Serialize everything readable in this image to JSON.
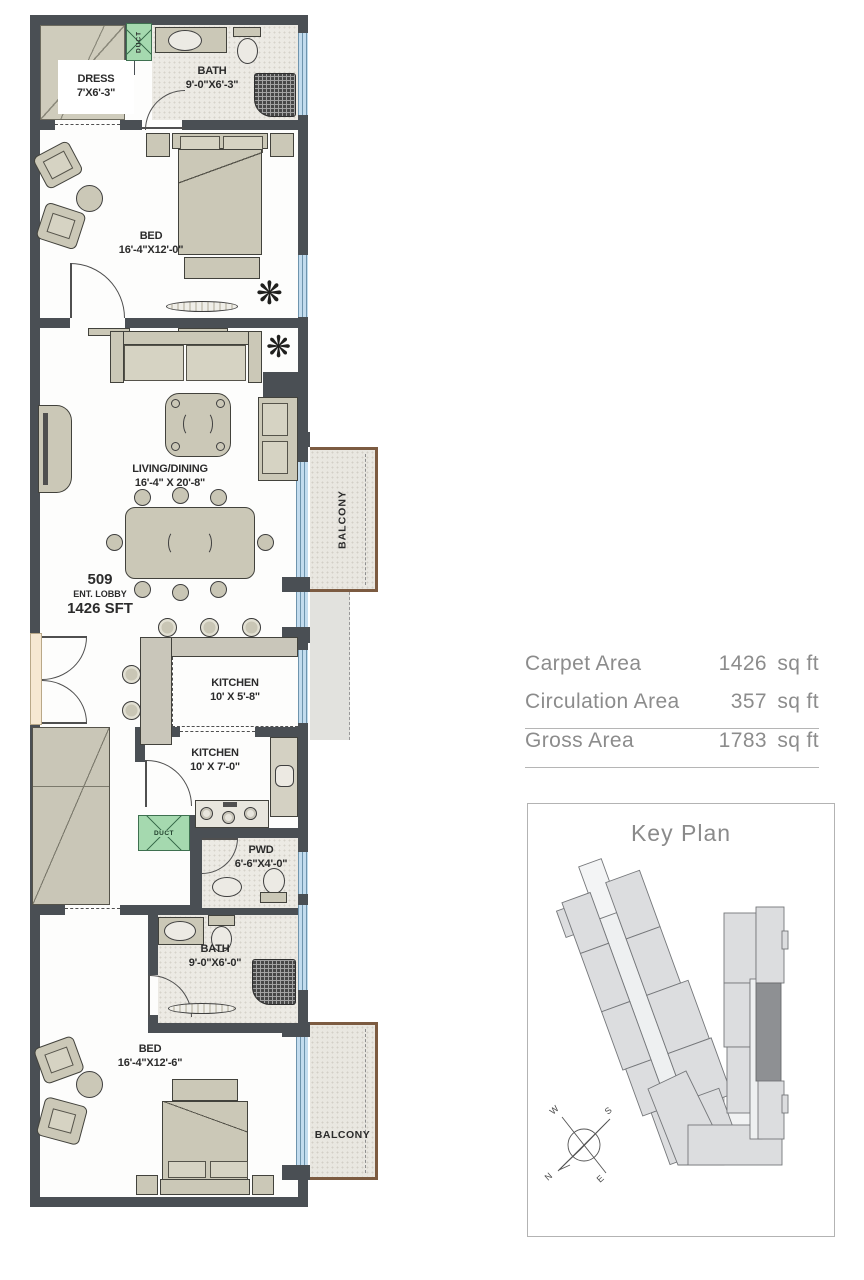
{
  "plan": {
    "unit": {
      "number": "509",
      "label": "ENT. LOBBY",
      "area": "1426 SFT"
    },
    "rooms": {
      "dress": {
        "name": "DRESS",
        "dim": "7'X6'-3\""
      },
      "bath_top": {
        "name": "BATH",
        "dim": "9'-0\"X6'-3\""
      },
      "bed_top": {
        "name": "BED",
        "dim": "16'-4\"X12'-0\""
      },
      "living": {
        "name": "LIVING/DINING",
        "dim": "16'-4\" X 20'-8\""
      },
      "kitchen_open": {
        "name": "KITCHEN",
        "dim": "10' X 5'-8\""
      },
      "kitchen": {
        "name": "KITCHEN",
        "dim": "10' X 7'-0\""
      },
      "pwd": {
        "name": "PWD",
        "dim": "6'-6\"X4'-0\""
      },
      "bath_bottom": {
        "name": "BATH",
        "dim": "9'-0\"X6'-0\""
      },
      "bed_bottom": {
        "name": "BED",
        "dim": "16'-4\"X12'-6\""
      }
    },
    "balconies": {
      "mid": "BALCONY",
      "bottom": "BALCONY"
    },
    "ducts": {
      "top": "DUCT",
      "mid": "DUCT"
    }
  },
  "area_table": {
    "rows": [
      {
        "label": "Carpet Area",
        "value": "1426",
        "unit": "sq ft"
      },
      {
        "label": "Circulation Area",
        "value": "357",
        "unit": "sq ft"
      },
      {
        "label": "Gross Area",
        "value": "1783",
        "unit": "sq ft"
      }
    ]
  },
  "key_plan": {
    "title": "Key Plan",
    "compass": {
      "n": "N",
      "s": "S",
      "e": "E",
      "w": "W"
    }
  },
  "colors": {
    "wall": "#4a4f54",
    "window": "#c3dcee",
    "duct": "#a5d9af",
    "furniture": "#cbc8b7",
    "balcony_trim": "#7c5b41",
    "table_text": "#8c8c8c",
    "highlight_unit": "#8e9093"
  }
}
